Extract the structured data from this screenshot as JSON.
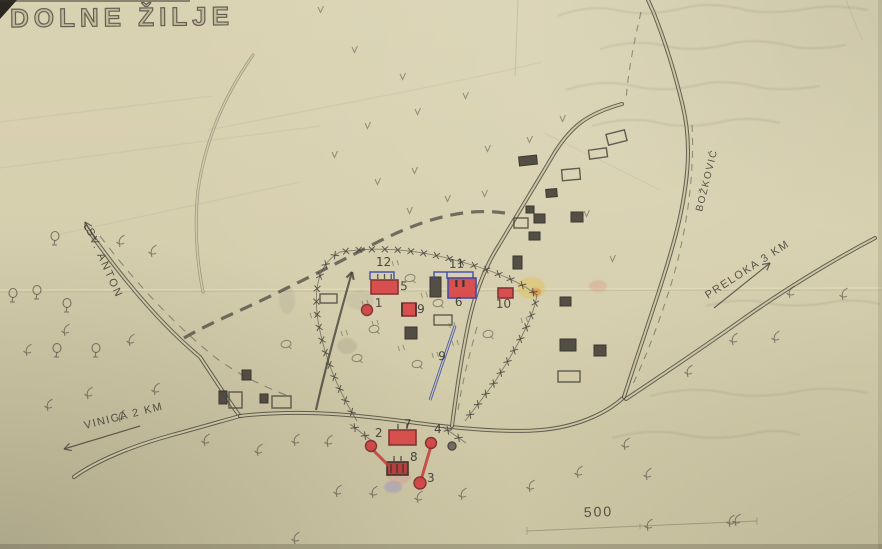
{
  "photo_of_map": {
    "title": "DOLNE ŽILJE",
    "labels": [
      {
        "text": "SV. ANTON",
        "x": 86,
        "y": 230,
        "rot": 66,
        "size": 11,
        "ls": 2
      },
      {
        "text": "VINICA 2 KM",
        "x": 85,
        "y": 429,
        "rot": -14,
        "size": 11,
        "ls": 1.5
      },
      {
        "text": "PRELOKA 3 KM",
        "x": 708,
        "y": 299,
        "rot": -33,
        "size": 11,
        "ls": 1.5
      },
      {
        "text": "BOŽKOVIĆ",
        "x": 702,
        "y": 212,
        "rot": -76,
        "size": 10,
        "ls": 1.5
      },
      {
        "text": "500",
        "x": 584,
        "y": 517,
        "rot": -2,
        "size": 14,
        "ls": 2
      }
    ],
    "site_numbers": [
      {
        "t": "1",
        "x": 375,
        "y": 307
      },
      {
        "t": "2",
        "x": 375,
        "y": 437
      },
      {
        "t": "3",
        "x": 427,
        "y": 482
      },
      {
        "t": "4",
        "x": 434,
        "y": 433
      },
      {
        "t": "5",
        "x": 400,
        "y": 290
      },
      {
        "t": "6",
        "x": 455,
        "y": 306
      },
      {
        "t": "7",
        "x": 404,
        "y": 428
      },
      {
        "t": "8",
        "x": 410,
        "y": 461
      },
      {
        "t": "9",
        "x": 417,
        "y": 313
      },
      {
        "t": "9",
        "x": 438,
        "y": 360
      },
      {
        "t": "10",
        "x": 496,
        "y": 308
      },
      {
        "t": "11",
        "x": 449,
        "y": 268
      },
      {
        "t": "12",
        "x": 376,
        "y": 266
      }
    ],
    "colors": {
      "paper": "#d6cfae",
      "pencil": "#46433b",
      "red_ink": "#cf4343",
      "blue_ink": "#3a49a8"
    },
    "roads": [
      {
        "d": "M86,227 C112,264 152,317 200,357 C216,381 228,400 239,415",
        "w": 4,
        "o": 0.8
      },
      {
        "d": "M74,477 C96,461 132,446 172,435 C198,428 222,421 240,416",
        "w": 4,
        "o": 0.8
      },
      {
        "d": "M240,416 C292,410 342,413 402,421 C452,428 506,433 541,430 C576,427 606,414 624,397",
        "w": 4,
        "o": 0.8
      },
      {
        "d": "M452,426 C456,394 461,359 469,321 C475,294 485,267 499,245 C516,217 536,184 555,152 C571,127 586,114 622,104",
        "w": 4,
        "o": 0.8
      },
      {
        "d": "M624,397 C644,334 669,267 680,217 C689,175 691,141 683,107 C676,77 665,41 653,11 C650,5 649,2 648,0",
        "w": 4,
        "o": 0.8
      },
      {
        "d": "M626,399 C659,377 701,349 743,319 C784,290 833,260 875,238",
        "w": 4,
        "o": 0.8
      },
      {
        "d": "M253,55 C224,96 205,142 198,190 C194,228 197,262 203,292",
        "w": 3,
        "o": 0.4
      }
    ],
    "dashes": [
      {
        "d": "M100,236 C130,276 172,323 216,358 C238,374 262,386 286,395",
        "da": "8 7",
        "w": 1.1,
        "o": 0.5
      },
      {
        "d": "M692,125 C695,175 686,242 666,300 C656,331 642,366 631,388",
        "da": "7 6",
        "w": 1.1,
        "o": 0.5
      },
      {
        "d": "M641,12 C634,42 628,72 626,100",
        "da": "7 6",
        "w": 1.1,
        "o": 0.5
      },
      {
        "d": "M477,327 C469,356 462,383 458,410",
        "da": "7 6",
        "w": 1.1,
        "o": 0.5
      },
      {
        "d": "M505,213 C455,206 408,226 366,248 C322,271 270,297 232,314 C212,323 196,331 184,338",
        "da": "13 8",
        "w": 3.2,
        "o": 0.7,
        "c": "#44413a"
      }
    ],
    "fence_paths": [
      "M340,252 C312,267 313,304 322,340 C330,372 344,400 357,421",
      "M340,252 C380,246 420,250 458,261 C495,271 521,282 537,295 C533,320 514,352 494,383 C482,399 473,411 465,421",
      "M350,424 L372,441",
      "M443,427 L466,443"
    ],
    "arrows": [
      {
        "d": "M140,426 L64,449",
        "hx": 64,
        "hy": 449,
        "ang": 163,
        "w": 1.2
      },
      {
        "d": "M714,308 L770,263",
        "hx": 770,
        "hy": 263,
        "ang": -39,
        "w": 1.2
      },
      {
        "d": "M96,240 L85,222",
        "hx": 85,
        "hy": 222,
        "ang": -121,
        "w": 1.2
      },
      {
        "d": "M316,410 C326,365 339,318 352,272",
        "hx": 352,
        "hy": 272,
        "ang": -74,
        "w": 2.2
      }
    ],
    "red_buildings": [
      {
        "x": 371,
        "y": 280,
        "w": 27,
        "h": 14,
        "ticks": 3,
        "style": "plain"
      },
      {
        "x": 448,
        "y": 278,
        "w": 28,
        "h": 20,
        "ticks": 0,
        "style": "blue"
      },
      {
        "x": 498,
        "y": 288,
        "w": 15,
        "h": 10,
        "ticks": 0,
        "style": "plain"
      },
      {
        "x": 389,
        "y": 430,
        "w": 27,
        "h": 15,
        "ticks": 2,
        "style": "plain"
      },
      {
        "x": 387,
        "y": 462,
        "w": 21,
        "h": 13,
        "ticks": 2,
        "style": "dark"
      },
      {
        "x": 402,
        "y": 303,
        "w": 14,
        "h": 13,
        "ticks": 0,
        "style": "sides"
      }
    ],
    "dark_buildings": [
      [
        430,
        277,
        11,
        20,
        0
      ],
      [
        513,
        256,
        9,
        13,
        0
      ],
      [
        405,
        327,
        12,
        12,
        0
      ],
      [
        519,
        156,
        18,
        9,
        -6
      ],
      [
        546,
        189,
        11,
        8,
        -5
      ],
      [
        526,
        206,
        8,
        7,
        0
      ],
      [
        534,
        214,
        11,
        9,
        0
      ],
      [
        571,
        212,
        12,
        10,
        0
      ],
      [
        529,
        232,
        11,
        8,
        0
      ],
      [
        560,
        297,
        11,
        9,
        0
      ],
      [
        560,
        339,
        16,
        12,
        0
      ],
      [
        594,
        345,
        12,
        11,
        0
      ],
      [
        242,
        370,
        9,
        10,
        0
      ],
      [
        219,
        391,
        8,
        13,
        0
      ],
      [
        260,
        394,
        8,
        9,
        0
      ]
    ],
    "outline_buildings": [
      [
        607,
        132,
        19,
        11,
        -14
      ],
      [
        589,
        149,
        18,
        9,
        -8
      ],
      [
        562,
        169,
        18,
        11,
        -5
      ],
      [
        514,
        218,
        14,
        10,
        0
      ],
      [
        558,
        371,
        22,
        11,
        0
      ],
      [
        229,
        392,
        13,
        16,
        0
      ],
      [
        272,
        396,
        19,
        12,
        0
      ],
      [
        320,
        294,
        17,
        9,
        0
      ],
      [
        434,
        315,
        18,
        10,
        0
      ]
    ],
    "red_dots": [
      [
        367,
        310,
        5.5,
        "r"
      ],
      [
        371,
        446,
        5.5,
        "r"
      ],
      [
        431,
        443,
        5.5,
        "r"
      ],
      [
        420,
        483,
        6,
        "r"
      ],
      [
        452,
        446,
        4,
        "g"
      ]
    ],
    "red_links": [
      "M371,448 L389,466",
      "M431,446 L421,480"
    ],
    "blue_marks": {
      "line": "M455,326 L430,400",
      "brackets": [
        "M370,280 L370,272 L394,272 L394,279",
        "M434,279 L434,272 L473,272 L473,278",
        "M447,272 L447,279"
      ]
    },
    "trees": [
      [
        55,
        240
      ],
      [
        13,
        297
      ],
      [
        37,
        294
      ],
      [
        67,
        307
      ],
      [
        57,
        352
      ],
      [
        96,
        352
      ]
    ],
    "tree_ovals": [
      [
        410,
        278
      ],
      [
        438,
        303
      ],
      [
        374,
        329
      ],
      [
        357,
        358
      ],
      [
        417,
        364
      ],
      [
        286,
        344
      ],
      [
        488,
        334
      ]
    ],
    "shrubs": [
      [
        120,
        243
      ],
      [
        152,
        253
      ],
      [
        65,
        332
      ],
      [
        27,
        352
      ],
      [
        130,
        342
      ],
      [
        155,
        391
      ],
      [
        88,
        395
      ],
      [
        48,
        407
      ],
      [
        120,
        418
      ],
      [
        205,
        442
      ],
      [
        258,
        452
      ],
      [
        295,
        442
      ],
      [
        328,
        443
      ],
      [
        337,
        493
      ],
      [
        373,
        494
      ],
      [
        418,
        499
      ],
      [
        462,
        496
      ],
      [
        530,
        488
      ],
      [
        578,
        474
      ],
      [
        625,
        446
      ],
      [
        647,
        476
      ],
      [
        688,
        373
      ],
      [
        733,
        341
      ],
      [
        775,
        339
      ],
      [
        790,
        294
      ],
      [
        843,
        296
      ],
      [
        736,
        522
      ],
      [
        648,
        527
      ],
      [
        730,
        523
      ],
      [
        295,
        540
      ]
    ],
    "grass": [
      [
        318,
        7
      ],
      [
        352,
        47
      ],
      [
        400,
        74
      ],
      [
        415,
        109
      ],
      [
        365,
        123
      ],
      [
        463,
        93
      ],
      [
        485,
        146
      ],
      [
        412,
        168
      ],
      [
        375,
        179
      ],
      [
        332,
        152
      ],
      [
        445,
        196
      ],
      [
        482,
        191
      ],
      [
        407,
        208
      ],
      [
        527,
        137
      ],
      [
        560,
        116
      ],
      [
        584,
        211
      ],
      [
        610,
        256
      ]
    ],
    "tick_pairs": [
      [
        392,
        261
      ],
      [
        421,
        293
      ],
      [
        449,
        323
      ],
      [
        372,
        321
      ],
      [
        398,
        346
      ],
      [
        432,
        353
      ],
      [
        362,
        301
      ],
      [
        341,
        331
      ],
      [
        310,
        313
      ],
      [
        452,
        341
      ],
      [
        521,
        318
      ]
    ],
    "stains": [
      [
        531,
        288,
        14,
        11,
        "#e0c14f",
        0.45
      ],
      [
        536,
        292,
        5,
        4,
        "#d4773f",
        0.5
      ],
      [
        598,
        286,
        9,
        6,
        "#d98a7a",
        0.28
      ],
      [
        393,
        487,
        9,
        6,
        "#8f82c8",
        0.35
      ],
      [
        399,
        476,
        12,
        8,
        "#e0788a",
        0.22
      ],
      [
        347,
        346,
        10,
        8,
        "#97917f",
        0.25
      ],
      [
        360,
        300,
        14,
        10,
        "#a39c88",
        0.2
      ],
      [
        287,
        300,
        8,
        14,
        "#97917f",
        0.18
      ]
    ],
    "bleed_writing": [
      "M558,16 C578,8 600,6 622,11 C642,15 664,13 684,8 C704,3 726,5 746,10 C764,14 790,12 812,8 C830,5 852,7 868,10",
      "M600,49 C622,42 646,41 666,46 C686,51 710,49 730,44 C748,39 772,41 790,46 C806,50 828,48 846,45",
      "M566,90 C590,82 614,81 634,86 C654,91 678,90 698,85 C716,80 740,82 758,87 C774,91 800,89 820,86",
      "M592,126 C616,119 640,118 660,123 C680,128 706,126 726,121 C742,117 764,119 780,123",
      "M706,306 C728,300 750,299 768,303 C786,307 812,306 832,302 C848,299 868,301 880,304",
      "M650,396 C676,389 704,388 726,393 C748,398 776,396 800,391 C820,387 848,389 868,393",
      "M612,438 C638,431 664,430 686,435 C708,440 734,438 756,433 C772,429 788,431 800,435"
    ],
    "scratches": [
      "M0,168 L320,126",
      "M52,236 L300,182",
      "M0,122 L212,96",
      "M208,130 C330,106 452,84 542,62",
      "M544,133 C592,156 630,175 660,190"
    ],
    "creases": [
      {
        "d": "M0,290 L882,288",
        "c": "#ebe4c1",
        "w": 1.2,
        "o": 0.55
      },
      {
        "d": "M0,292 L882,290",
        "c": "#a59d7e",
        "w": 1,
        "o": 0.3
      },
      {
        "d": "M518,0 L515,76",
        "c": "#8f8870",
        "w": 1,
        "o": 0.28
      },
      {
        "d": "M846,0 L862,40",
        "c": "#8f8870",
        "w": 1,
        "o": 0.2
      },
      {
        "d": "M760,549 L882,476",
        "c": "#b8b092",
        "w": 1,
        "o": 0.12
      }
    ],
    "scale_bar": {
      "line": "M527,531 L757,521",
      "ticks": [
        "M527,527 L527,535",
        "M640,523 L640,529",
        "M757,517 L757,525"
      ]
    }
  }
}
